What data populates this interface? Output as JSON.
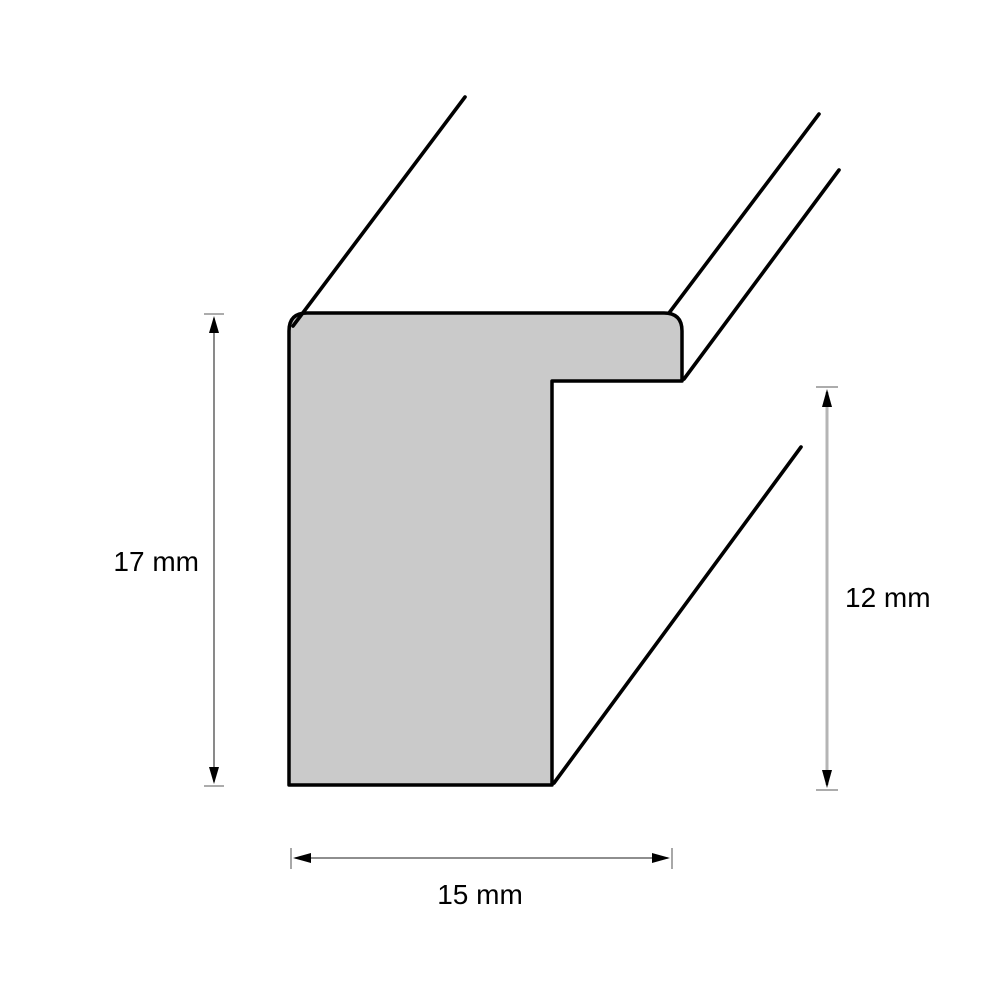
{
  "diagram": {
    "kind": "profile-cross-section",
    "dimensions": [
      {
        "label": "17 mm",
        "value": 17,
        "unit": "mm",
        "edge": "left-height",
        "orientation": "vertical"
      },
      {
        "label": "12 mm",
        "value": 12,
        "unit": "mm",
        "edge": "right-height",
        "orientation": "vertical"
      },
      {
        "label": "15 mm",
        "value": 15,
        "unit": "mm",
        "edge": "bottom-width",
        "orientation": "horizontal"
      }
    ],
    "colors": {
      "background": "#ffffff",
      "profile_fill": "#cacaca",
      "profile_stroke": "#000000",
      "dimension_line": "#4a4a4a",
      "dimension_line_secondary": "#b5b5b5",
      "arrowhead": "#000000",
      "label_text": "#000000"
    }
  }
}
